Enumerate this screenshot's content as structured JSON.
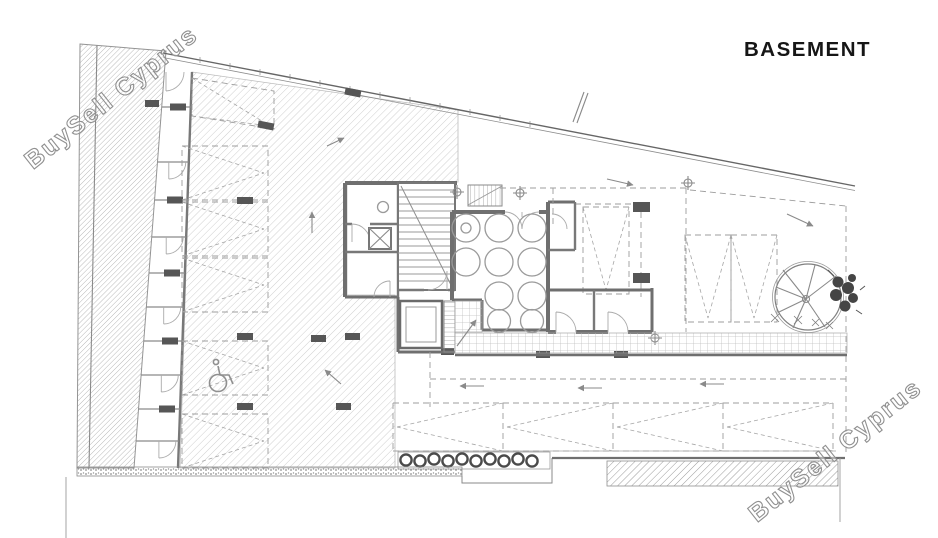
{
  "title": "BASEMENT",
  "watermark": "BuySell Cyprus",
  "drawing": {
    "kind": "architectural basement floor plan",
    "floor_label": "BASEMENT"
  },
  "icons": {
    "wheelchair": "accessible-parking symbol",
    "tree": "tree plan symbol",
    "shrub": "shrub row symbol",
    "survey_marker": "crosshair benchmark symbol",
    "elevator": "crossed-box lift shaft symbol",
    "stairs": "stair run with break line",
    "arrows": "drive direction arrows"
  },
  "colors": {
    "background": "#ffffff",
    "wall": "#6f6f6f",
    "hatch_light": "#cfcfcf",
    "hatch_dense": "#a9a9a9",
    "dashed_line": "#9d9d9d",
    "tile_grid": "#c0c0c0",
    "title_ink": "#161616",
    "watermark_outline": "#909090"
  }
}
